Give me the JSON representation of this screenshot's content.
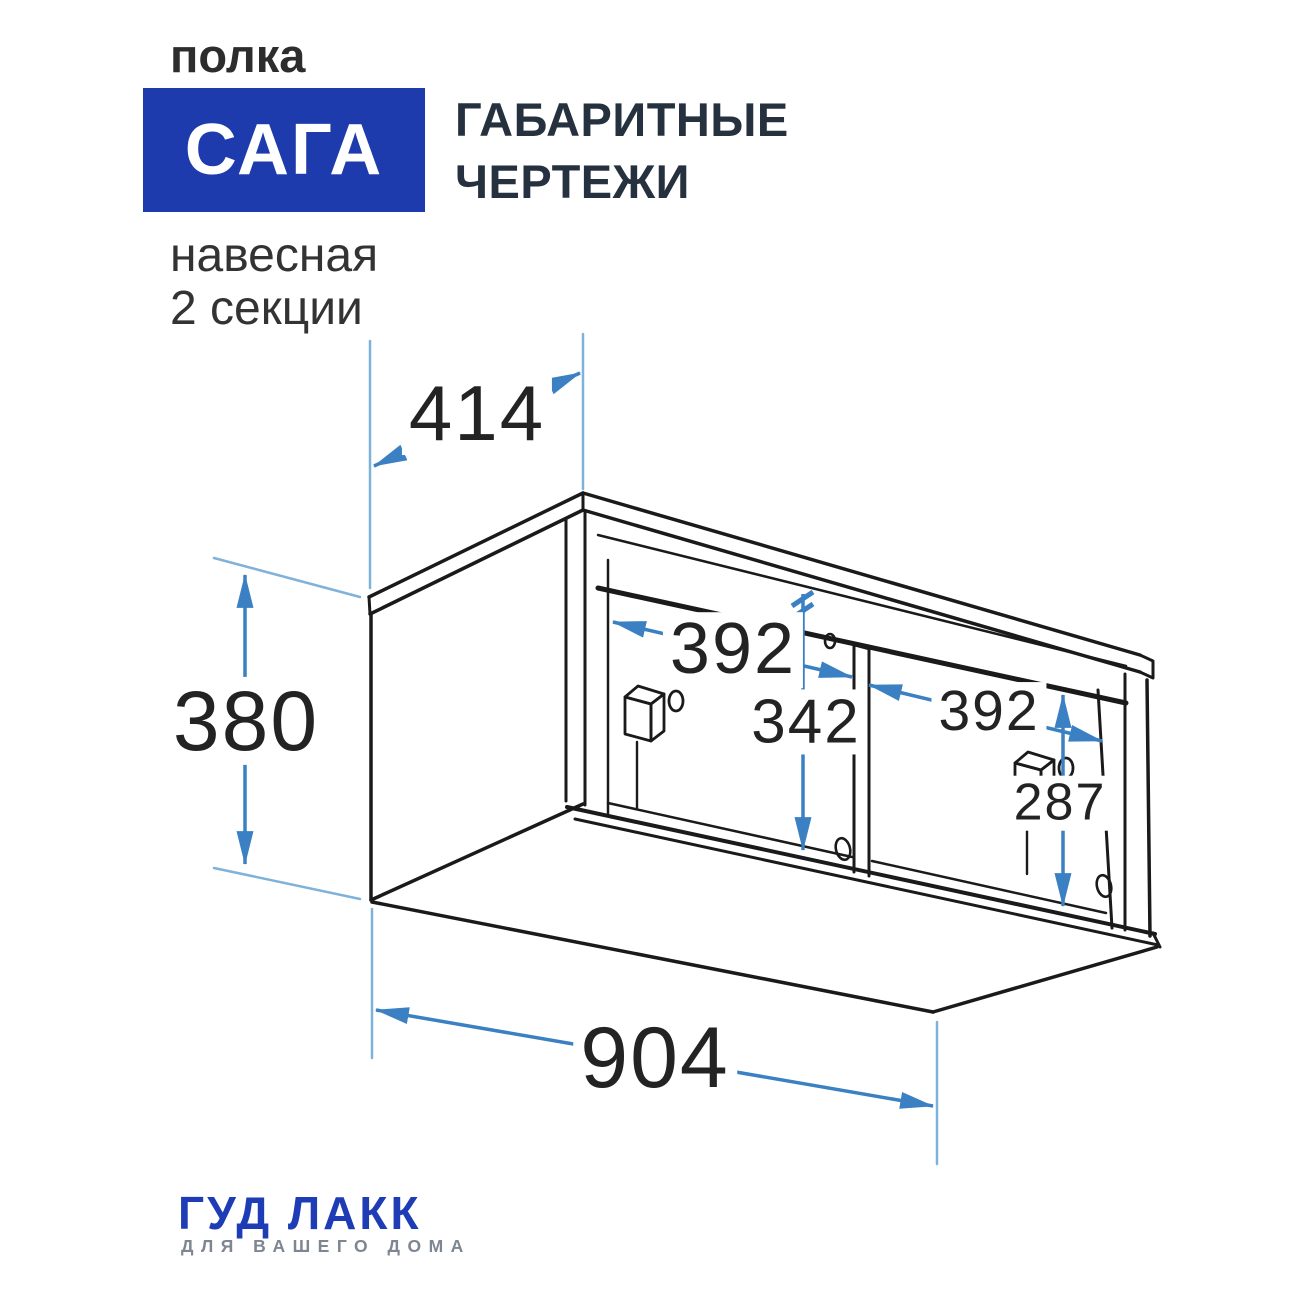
{
  "header": {
    "product_type": "полка",
    "product_name": "САГА",
    "title_line1": "ГАБАРИТНЫЕ",
    "title_line2": "ЧЕРТЕЖИ",
    "subtitle_line1": "навесная",
    "subtitle_line2": "2 секции"
  },
  "drawing": {
    "type": "dimensional-drawing",
    "object": "wall-mounted shelf, 2 sections, isometric view",
    "dimensions": {
      "depth": "414",
      "height": "380",
      "width": "904",
      "section_width_left": "392",
      "inner_height_center": "342",
      "section_width_right": "392",
      "inner_height_right": "287"
    }
  },
  "footer": {
    "brand": "ГУД ЛАКК",
    "tagline": "ДЛЯ ВАШЕГО ДОМА"
  },
  "colors": {
    "accent_blue": "#1e3bad",
    "title_dark": "#26313f",
    "dimension_blue": "#3a80c2",
    "extension_blue": "#7fb2da",
    "line_black": "#1a1a1a",
    "brand_blue": "#1d3cb5",
    "tagline_gray": "#7d8691"
  }
}
